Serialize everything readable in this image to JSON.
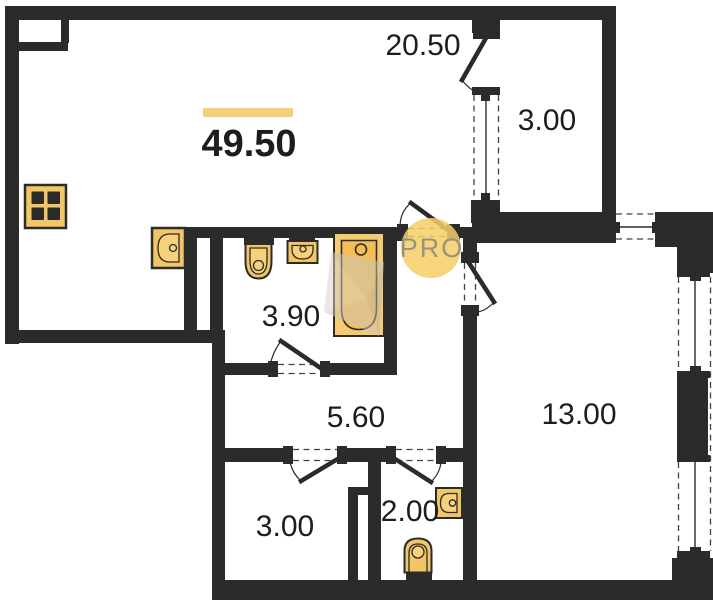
{
  "plan": {
    "total_area": "49.50",
    "rooms": {
      "living_kitchen": "20.50",
      "balcony": "3.00",
      "bathroom": "3.90",
      "hallway": "5.60",
      "room": "13.00",
      "small_room": "3.00",
      "wc": "2.00"
    },
    "badge": "PRO",
    "colors": {
      "wall": "#2b2b29",
      "fixture": "#f2c566",
      "fixture_inner": "#f6d17a",
      "bathtub": "#f5cb72",
      "bathtub_inner": "#f3bf55",
      "area_bar": "#f5cf76",
      "badge_bg": "#f6ce67",
      "badge_text": "#9a9280",
      "label": "#1d1d1b",
      "watermark": "#c6c1b9"
    },
    "icons": {
      "stove": "stove-icon",
      "kitchen_sink": "kitchen-sink-icon",
      "toilet": "toilet-icon",
      "washbasin": "washbasin-icon",
      "bathtub": "bathtub-icon",
      "wc_washbasin": "wc-washbasin-icon",
      "wc_toilet": "wc-toilet-icon",
      "watermark_gem": "gem-watermark-icon"
    }
  }
}
